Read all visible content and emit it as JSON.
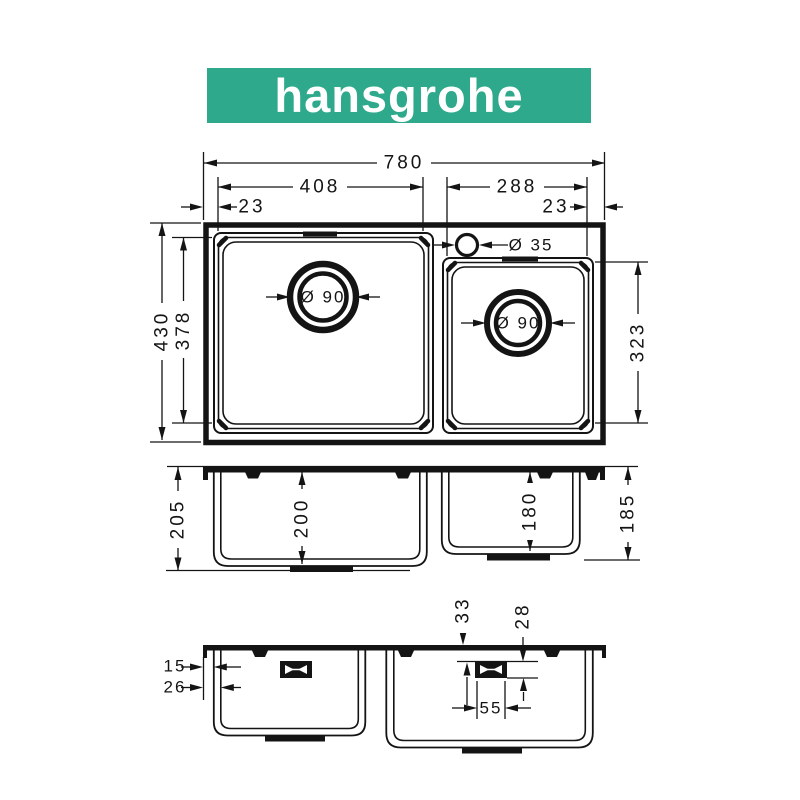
{
  "logo": {
    "text": "hansgrohe",
    "bg_color": "#2fa98b"
  },
  "colors": {
    "line": "#141414",
    "background": "#ffffff"
  },
  "top_view": {
    "width_total": "780",
    "width_left_bowl": "408",
    "width_right_bowl": "288",
    "margin_left": "23",
    "margin_right": "23",
    "depth_total": "430",
    "depth_left_bowl": "378",
    "depth_right_bowl": "323",
    "faucet_hole_diameter": "Ø 35",
    "left_drain_diameter": "Ø 90",
    "right_drain_diameter": "Ø 90"
  },
  "front_view": {
    "height_outer_left": "205",
    "height_left_bowl": "200",
    "height_right_bowl": "180",
    "height_outer_right": "185"
  },
  "back_view": {
    "rim_to_wall_outer": "15",
    "rim_to_wall_inner": "26",
    "clip_offset_from_top": "33",
    "clip_offset_inner": "28",
    "clip_width": "55"
  }
}
